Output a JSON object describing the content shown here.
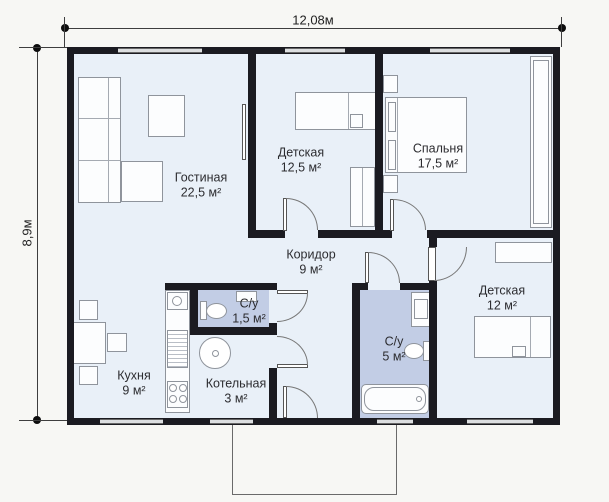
{
  "plan": {
    "type_note": "single-storey house floor plan",
    "dimensions": {
      "width_label": "12,08м",
      "height_label": "8,9м"
    },
    "rooms": {
      "living": {
        "name": "Гостиная",
        "area": "22,5 м²"
      },
      "kids1": {
        "name": "Детская",
        "area": "12,5 м²"
      },
      "bedroom": {
        "name": "Спальня",
        "area": "17,5 м²"
      },
      "corridor": {
        "name": "Коридор",
        "area": "9 м²"
      },
      "wc_small": {
        "name": "С/у",
        "area": "1,5 м²"
      },
      "kitchen": {
        "name": "Кухня",
        "area": "9 м²"
      },
      "boiler": {
        "name": "Котельная",
        "area": "3 м²"
      },
      "wc_big": {
        "name": "С/у",
        "area": "5 м²"
      },
      "kids2": {
        "name": "Детская",
        "area": "12 м²"
      }
    },
    "colors": {
      "background": "#f7f7f4",
      "wall": "#1b1b21",
      "room_fill": "#e9f0f8",
      "wet_room_fill": "#c2cde5"
    }
  }
}
